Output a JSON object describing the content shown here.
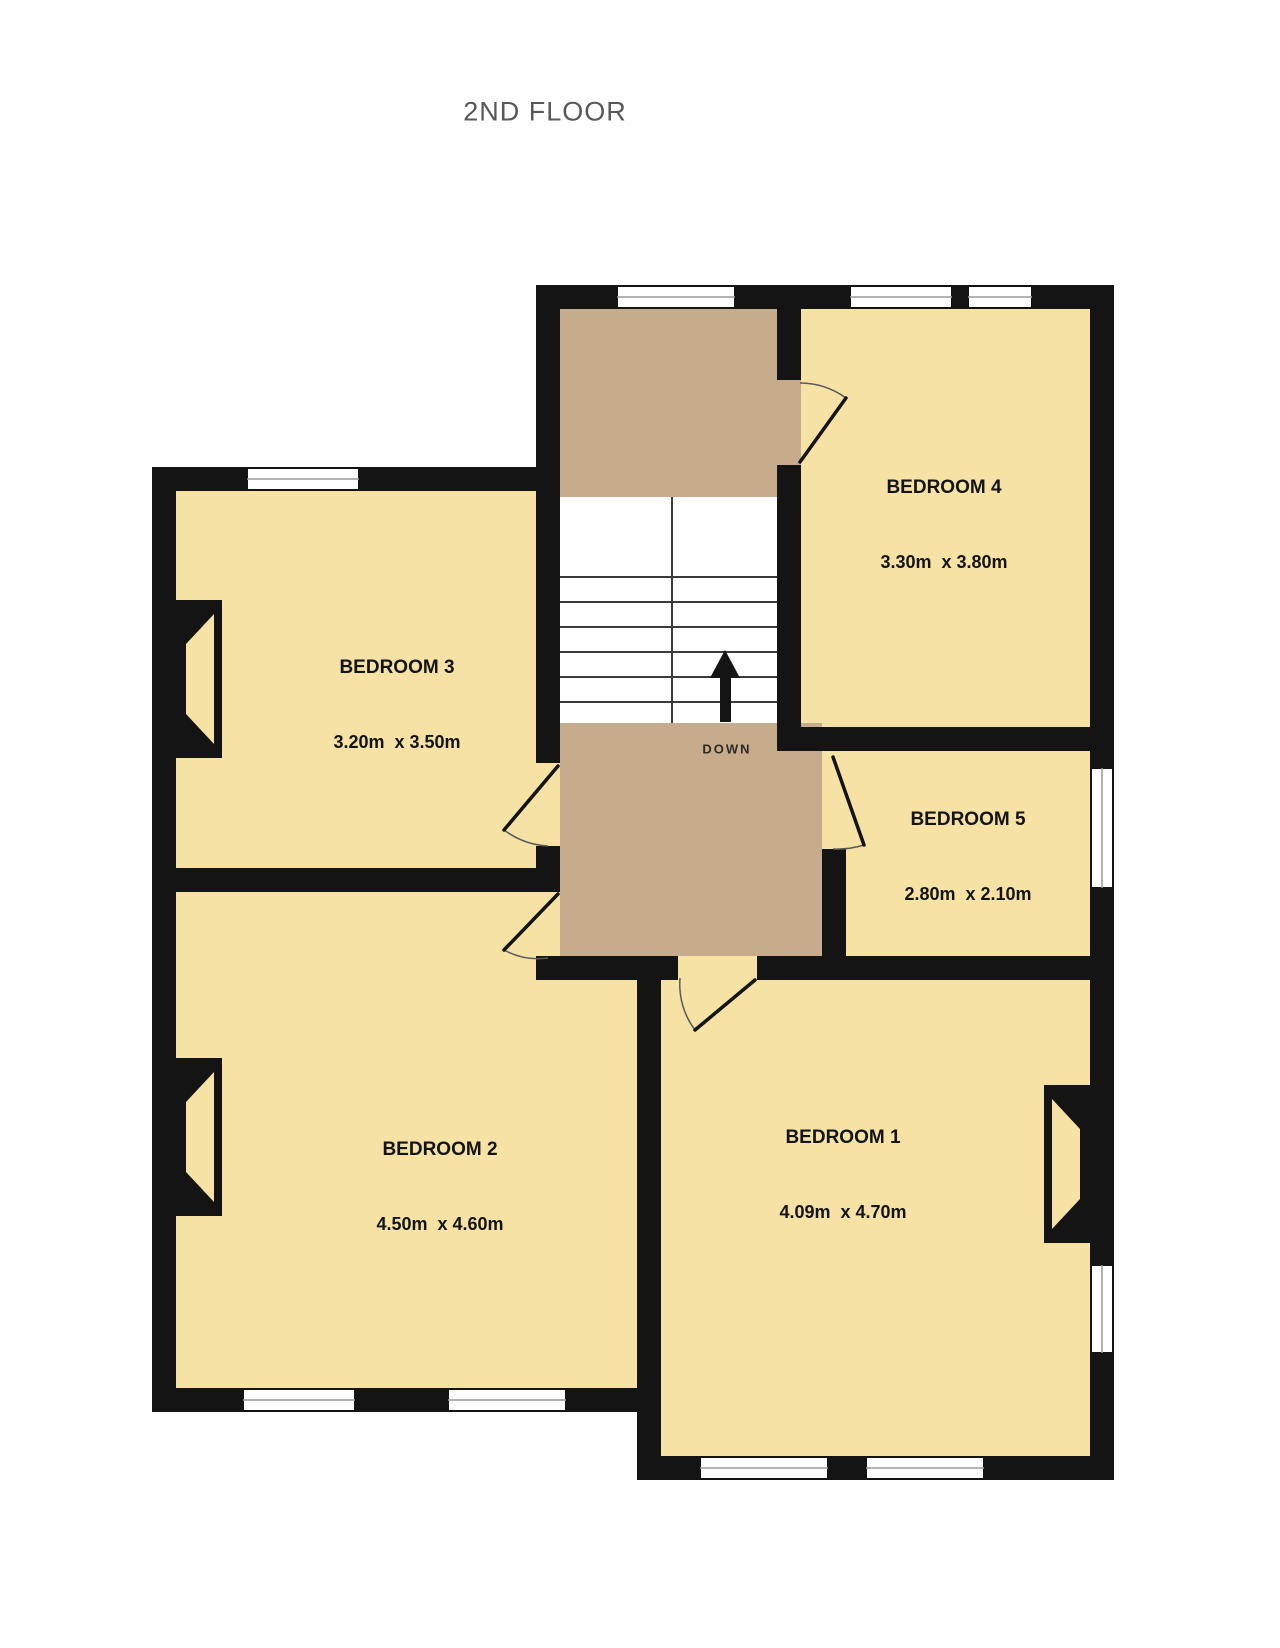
{
  "title": "2ND FLOOR",
  "stairs": {
    "direction_label": "DOWN"
  },
  "rooms": [
    {
      "id": "bedroom-1",
      "name": "BEDROOM 1",
      "dimensions": "4.09m  x 4.70m"
    },
    {
      "id": "bedroom-2",
      "name": "BEDROOM 2",
      "dimensions": "4.50m  x 4.60m"
    },
    {
      "id": "bedroom-3",
      "name": "BEDROOM 3",
      "dimensions": "3.20m  x 3.50m"
    },
    {
      "id": "bedroom-4",
      "name": "BEDROOM 4",
      "dimensions": "3.30m  x 3.80m"
    },
    {
      "id": "bedroom-5",
      "name": "BEDROOM 5",
      "dimensions": "2.80m  x 2.10m"
    }
  ],
  "colors": {
    "wall": "#141414",
    "room_fill": "#f5e2a4",
    "landing_fill": "#c6ac8c",
    "stair_tread": "#3a3a3a",
    "window_glass": "#ffffff",
    "title_text": "#58585a",
    "label_text": "#141414"
  }
}
